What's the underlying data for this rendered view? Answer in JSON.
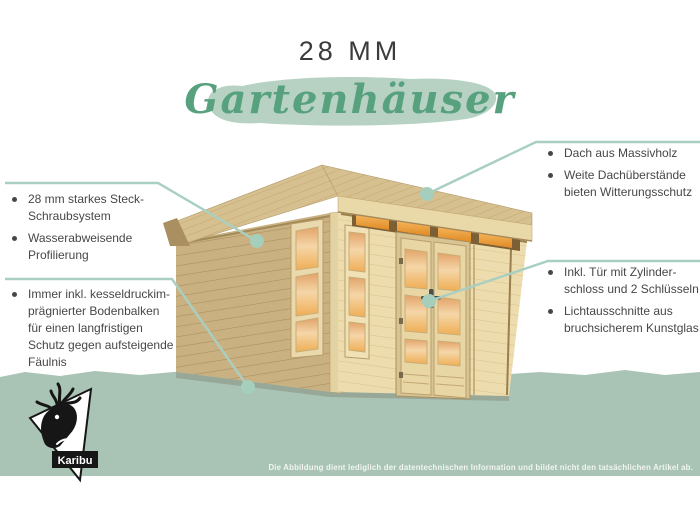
{
  "header": {
    "kicker": "28 MM",
    "title": "Gartenhäuser"
  },
  "callouts": {
    "left_top": {
      "items": [
        "28 mm starkes Steck-\nSchraubsystem",
        "Wasserabweisende\nProfilierung"
      ]
    },
    "left_bottom": {
      "items": [
        "Immer inkl. kesseldruckim-\nprägnierter Bodenbalken\nfür einen langfristigen\nSchutz gegen aufsteigende\nFäulnis"
      ]
    },
    "right_top": {
      "items": [
        "Dach aus Massivholz",
        "Weite Dachüberstände\nbieten Witterungsschutz"
      ]
    },
    "right_middle": {
      "items": [
        "Inkl. Tür mit Zylinder-\nschloss und 2 Schlüsseln",
        "Lichtausschnitte aus\nbruchsicherem Kunstglas"
      ]
    }
  },
  "footer": {
    "disclaimer": "Die Abbildung dient lediglich der datentechnischen Information und bildet nicht den tatsächlichen Artikel ab."
  },
  "logo": {
    "brand": "Karibu"
  },
  "colors": {
    "accent_green": "#57a17e",
    "brush_green": "#b7d2c3",
    "leader_teal": "#a9cfc2",
    "band_green": "#a9c3b5",
    "text_dark": "#47474a",
    "wood_light": "#eddcad",
    "wood_mid": "#c9b182",
    "glass_orange": "#eda74f"
  }
}
